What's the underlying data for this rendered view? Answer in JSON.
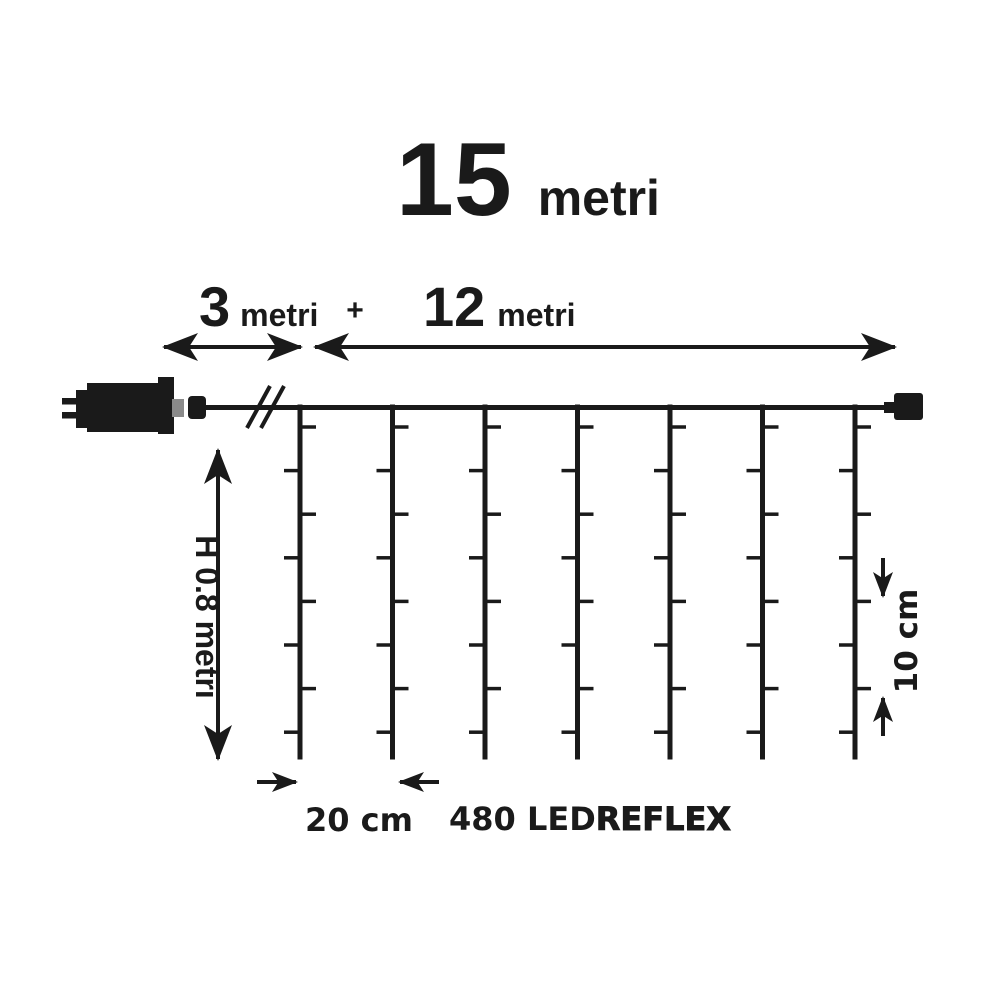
{
  "diagram": {
    "title": {
      "number": "15",
      "unit": "metri"
    },
    "top_dimensions": {
      "segment1": {
        "value": "3",
        "unit": "metri"
      },
      "plus_sign": "+",
      "segment2": {
        "value": "12",
        "unit": "metri"
      }
    },
    "height_label": "H 0.8 metri",
    "vertical_spacing_label": "10 cm",
    "horizontal_spacing_label": "20 cm",
    "led_label": {
      "count": "480 LED",
      "brand": "REFLEX"
    },
    "curtain": {
      "drop_count": 7,
      "leds_per_drop": 8
    },
    "colors": {
      "line": "#1a1a1a",
      "connector_gray": "#8a8a8a",
      "background": "#ffffff"
    }
  }
}
